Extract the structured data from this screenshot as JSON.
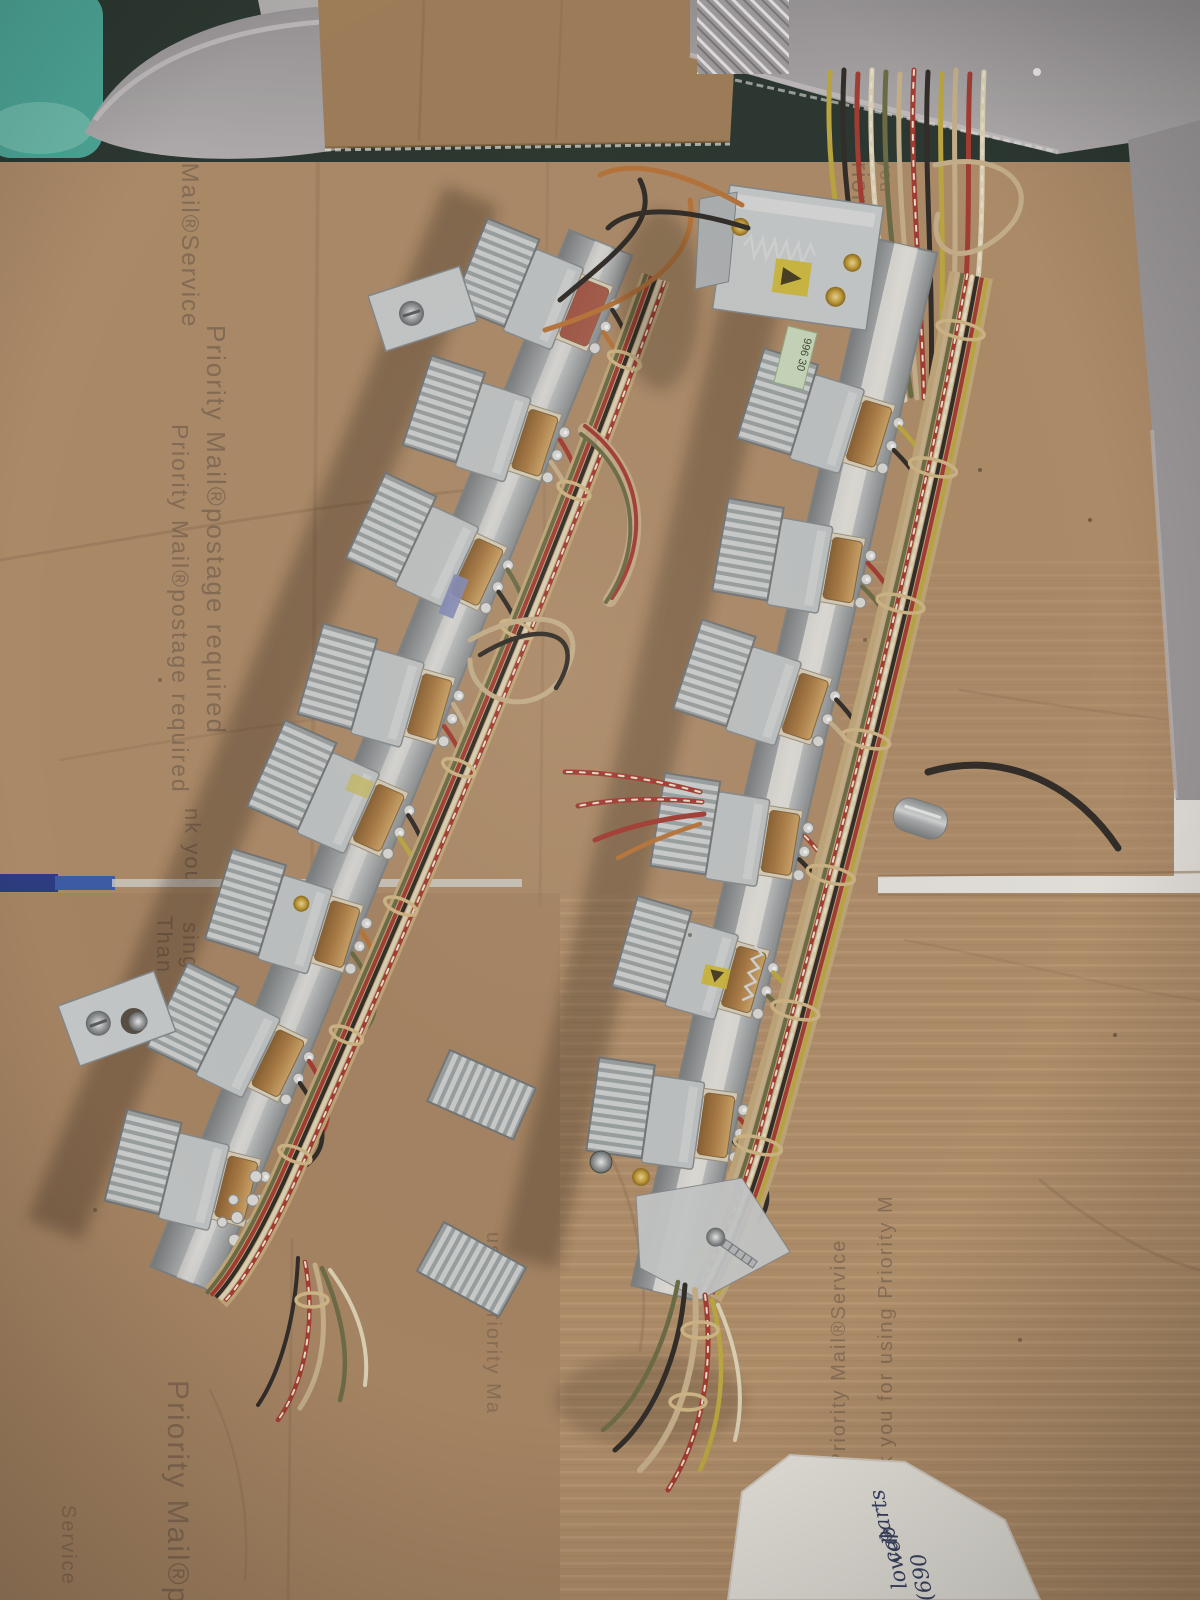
{
  "photo": {
    "cardboard_prints": [
      {
        "text": "y Mail®Service"
      },
      {
        "text": "Priority Mail®postage required"
      },
      {
        "text": "Priority Mail®postage required"
      },
      {
        "text": "nk you"
      },
      {
        "text": "Than"
      },
      {
        "text": "sing"
      },
      {
        "text": "Thank you"
      },
      {
        "text": "using Priorit"
      },
      {
        "text": "Thank you"
      },
      {
        "text": "using Priority Ma"
      },
      {
        "text": "using Priority Mail®Service"
      },
      {
        "text": "Thank you for using Priority M"
      },
      {
        "text": "Priority Mail®pos"
      },
      {
        "text": "Service"
      }
    ],
    "handwritten_note": {
      "lines": [
        {
          "text": "parts"
        },
        {
          "text": "cab"
        },
        {
          "text": "lower"
        },
        {
          "text": "(690"
        }
      ]
    },
    "relay_label": {
      "text": "996 30"
    },
    "colors": {
      "cardboard": "#b3916e",
      "cardboard_dark": "#9c7b59",
      "cardboard_print_ink": "#6a584a",
      "tote_gray": "#a3a0a2",
      "teal_object": "#4fae9f",
      "background_dark": "#2c3a33",
      "rail_metal": "#c3c7c9",
      "coil_copper": "#c59a62",
      "coil_red": "#a85a4e",
      "harness_tan": "#c7ae7f",
      "wire_red": "#a93f36",
      "wire_yellow": "#c2ae45",
      "wire_black": "#332f2b",
      "wire_green": "#70704a",
      "wire_orange": "#bf7a3e",
      "wire_cream": "#e4d9bb",
      "white_gap": "#eceae6",
      "blue_stripe": "#3f5fb0",
      "note_paper": "#efece6",
      "note_ink": "#3b4668"
    }
  }
}
